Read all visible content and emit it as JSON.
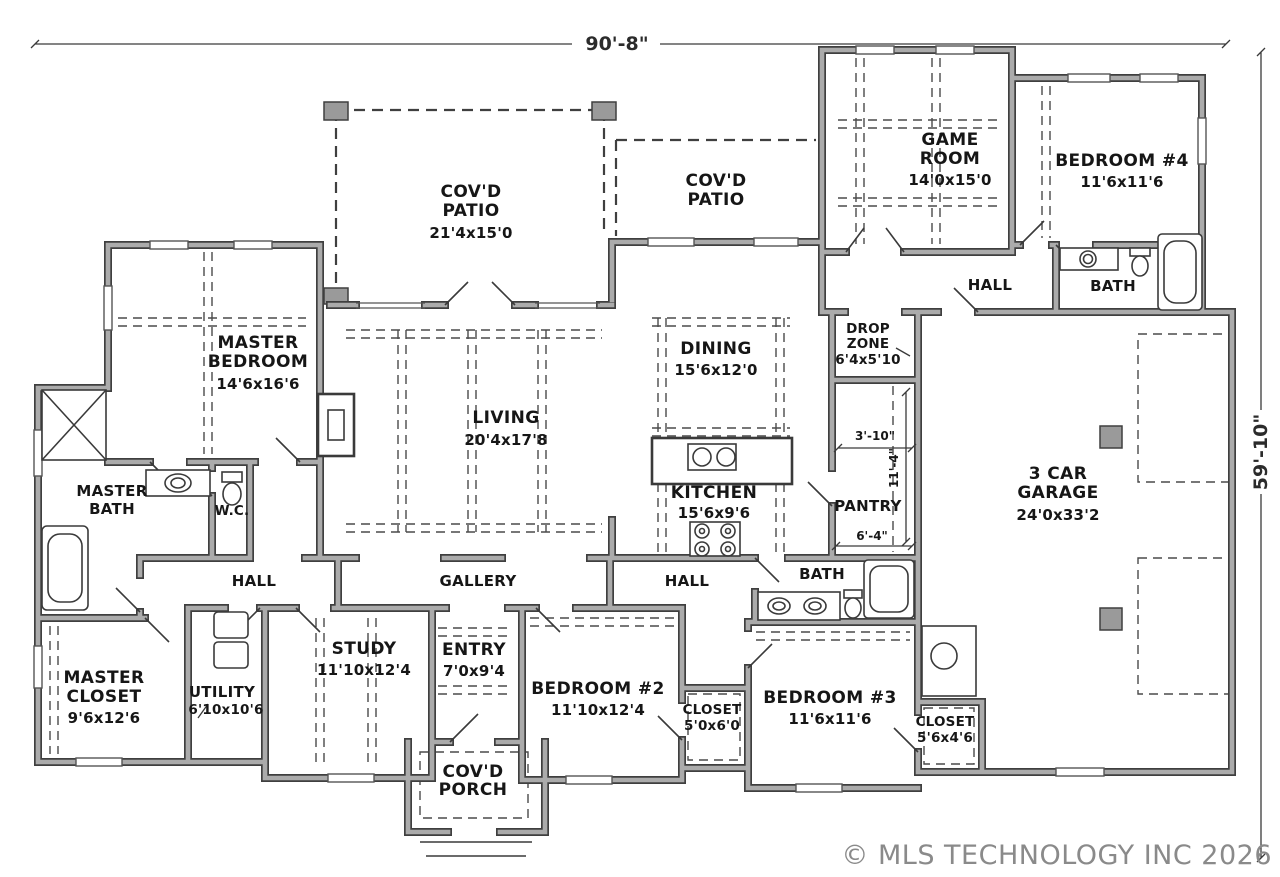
{
  "colors": {
    "wall_edge": "#3f3f3f",
    "wall_fill": "#ababab",
    "line": "#3a3a3a",
    "copyright_gray": "#8a8a8a"
  },
  "overall_dimensions": {
    "width": "90'-8\"",
    "depth": "59'-10\""
  },
  "interior_dimensions": {
    "d1": "3'-10\"",
    "d2": "11'-4\"",
    "d3": "6'-4\""
  },
  "copyright": "© MLS TECHNOLOGY INC 2026",
  "rooms": {
    "covd_patio_left": {
      "lines": [
        "COV'D",
        "PATIO",
        "21'4x15'0"
      ]
    },
    "covd_patio_right": {
      "lines": [
        "COV'D",
        "PATIO"
      ]
    },
    "game_room": {
      "lines": [
        "GAME",
        "ROOM",
        "14'0x15'0"
      ]
    },
    "bedroom_4": {
      "lines": [
        "BEDROOM #4",
        "11'6x11'6"
      ]
    },
    "hall_upper": {
      "lines": [
        "HALL"
      ]
    },
    "bath_upper": {
      "lines": [
        "BATH"
      ]
    },
    "master_bedroom": {
      "lines": [
        "MASTER",
        "BEDROOM",
        "14'6x16'6"
      ]
    },
    "dining": {
      "lines": [
        "DINING",
        "15'6x12'0"
      ]
    },
    "drop_zone": {
      "lines": [
        "DROP",
        "ZONE",
        "6'4x5'10"
      ]
    },
    "living": {
      "lines": [
        "LIVING",
        "20'4x17'8"
      ]
    },
    "master_bath": {
      "lines": [
        "MASTER",
        "BATH"
      ]
    },
    "water_closet": {
      "lines": [
        "W.C."
      ]
    },
    "kitchen": {
      "lines": [
        "KITCHEN",
        "15'6x9'6"
      ]
    },
    "pantry": {
      "lines": [
        "PANTRY"
      ]
    },
    "garage": {
      "lines": [
        "3 CAR",
        "GARAGE",
        "24'0x33'2"
      ]
    },
    "hall_left": {
      "lines": [
        "HALL"
      ]
    },
    "gallery": {
      "lines": [
        "GALLERY"
      ]
    },
    "hall_center": {
      "lines": [
        "HALL"
      ]
    },
    "bath_lower": {
      "lines": [
        "BATH"
      ]
    },
    "master_closet": {
      "lines": [
        "MASTER",
        "CLOSET",
        "9'6x12'6"
      ]
    },
    "utility": {
      "lines": [
        "UTILITY",
        "6'10x10'6"
      ]
    },
    "study": {
      "lines": [
        "STUDY",
        "11'10x12'4"
      ]
    },
    "entry": {
      "lines": [
        "ENTRY",
        "7'0x9'4"
      ]
    },
    "bedroom_2": {
      "lines": [
        "BEDROOM #2",
        "11'10x12'4"
      ]
    },
    "closet_2": {
      "lines": [
        "CLOSET",
        "5'0x6'0"
      ]
    },
    "bedroom_3": {
      "lines": [
        "BEDROOM #3",
        "11'6x11'6"
      ]
    },
    "closet_3": {
      "lines": [
        "CLOSET",
        "5'6x4'6"
      ]
    },
    "covd_porch": {
      "lines": [
        "COV'D",
        "PORCH"
      ]
    }
  }
}
